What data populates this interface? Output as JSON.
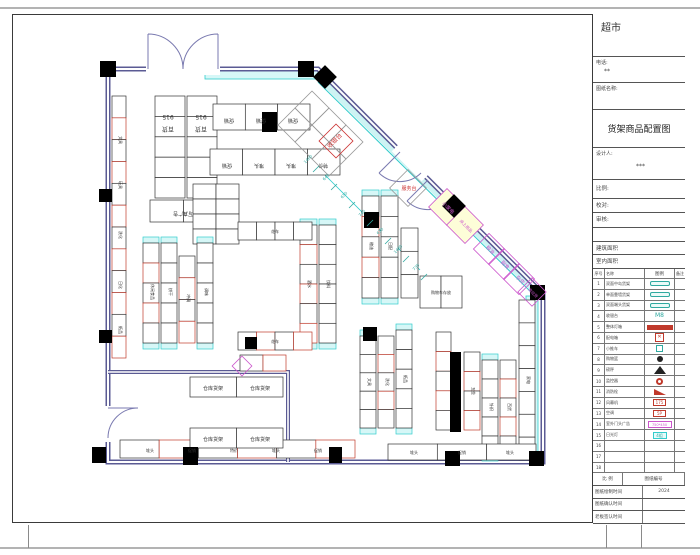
{
  "titleblock": {
    "store": "超市",
    "phone_label": "电话:",
    "phone": "**",
    "drawing_label": "图纸名称:",
    "title": "货架商品配置图",
    "designer_label": "设计人:",
    "designer": "***",
    "scale_label": "比例:",
    "check_label": "校对:",
    "audit_label": "审核:",
    "area1_label": "建筑面积",
    "area2_label": "室内面积",
    "legend_headers": [
      "序号",
      "名称",
      "图例",
      "备注"
    ],
    "legend_rows": [
      {
        "no": "1",
        "name": "双面中岛货架",
        "sym": "teal-pill",
        "symtext": "",
        "note": ""
      },
      {
        "no": "2",
        "name": "单面靠墙货架",
        "sym": "teal-pill",
        "symtext": "",
        "note": ""
      },
      {
        "no": "3",
        "name": "双面端头货架",
        "sym": "teal-pill",
        "symtext": "",
        "note": ""
      },
      {
        "no": "4",
        "name": "收银台",
        "sym": "teal-txt",
        "symtext": "M8",
        "note": ""
      },
      {
        "no": "5",
        "name": "整体灯箱",
        "sym": "red-bar",
        "symtext": "",
        "note": ""
      },
      {
        "no": "6",
        "name": "配电箱",
        "sym": "red-box",
        "symtext": "✕",
        "note": ""
      },
      {
        "no": "7",
        "name": "小推车",
        "sym": "teal-sm",
        "symtext": "",
        "note": ""
      },
      {
        "no": "8",
        "name": "购物篮",
        "sym": "black-dot",
        "symtext": "",
        "note": ""
      },
      {
        "no": "9",
        "name": "磅秤",
        "sym": "black-tri",
        "symtext": "",
        "note": ""
      },
      {
        "no": "10",
        "name": "监控器",
        "sym": "red-circle",
        "symtext": "",
        "note": ""
      },
      {
        "no": "11",
        "name": "消防栓",
        "sym": "red-flag",
        "symtext": "",
        "note": ""
      },
      {
        "no": "12",
        "name": "风幕机",
        "sym": "red-sm",
        "symtext": "175",
        "note": ""
      },
      {
        "no": "13",
        "name": "空调",
        "sym": "red-sm",
        "symtext": "5P",
        "note": ""
      },
      {
        "no": "14",
        "name": "室外门头广告",
        "sym": "magenta-box",
        "symtext": "750*450",
        "note": ""
      },
      {
        "no": "15",
        "name": "日光灯",
        "sym": "cyan-box",
        "symtext": "4组",
        "note": ""
      },
      {
        "no": "16",
        "name": "",
        "sym": "none",
        "symtext": "",
        "note": ""
      },
      {
        "no": "17",
        "name": "",
        "sym": "none",
        "symtext": "",
        "note": ""
      },
      {
        "no": "18",
        "name": "",
        "sym": "none",
        "symtext": "",
        "note": ""
      }
    ],
    "footer_headers": [
      "比 例",
      "图纸编号"
    ],
    "footer_rows": [
      {
        "label": "图纸绘制时间",
        "value": "2024"
      },
      {
        "label": "图纸确认时间",
        "value": ""
      },
      {
        "label": "老板签认时间",
        "value": ""
      }
    ]
  },
  "plan": {
    "labels": [
      {
        "t": "915",
        "x": 168,
        "y": 115,
        "r": 180,
        "s": 6
      },
      {
        "t": "百货",
        "x": 168,
        "y": 127,
        "r": 180,
        "s": 6
      },
      {
        "t": "915",
        "x": 201,
        "y": 115,
        "r": 180,
        "s": 6
      },
      {
        "t": "百货",
        "x": 201,
        "y": 127,
        "r": 180,
        "s": 6
      },
      {
        "t": "写真广告",
        "x": 183,
        "y": 212,
        "r": 180,
        "s": 5
      },
      {
        "t": "促销",
        "x": 229,
        "y": 119,
        "r": 180,
        "s": 5
      },
      {
        "t": "促销",
        "x": 261,
        "y": 119,
        "r": 180,
        "s": 5
      },
      {
        "t": "促销",
        "x": 293,
        "y": 119,
        "r": 180,
        "s": 5
      },
      {
        "t": "促销",
        "x": 227,
        "y": 164,
        "r": 180,
        "s": 5
      },
      {
        "t": "堆头",
        "x": 259,
        "y": 164,
        "r": 180,
        "s": 5
      },
      {
        "t": "堆头",
        "x": 291,
        "y": 164,
        "r": 180,
        "s": 5
      },
      {
        "t": "特价",
        "x": 323,
        "y": 164,
        "r": 180,
        "s": 5
      },
      {
        "t": "收银台",
        "x": 336,
        "y": 142,
        "r": -45,
        "c": "#cc3333",
        "s": 6
      },
      {
        "t": "服务台",
        "x": 409,
        "y": 190,
        "r": 0,
        "c": "#cc3333",
        "s": 5
      },
      {
        "t": "小家电",
        "x": 447,
        "y": 209,
        "r": 45,
        "c": "#cc55cc",
        "s": 5
      },
      {
        "t": "床上用品",
        "x": 465,
        "y": 227,
        "r": 45,
        "c": "#cc55cc",
        "s": 4
      },
      {
        "t": "粮油",
        "x": 489,
        "y": 251,
        "r": 45,
        "c": "#cc55cc",
        "s": 5
      },
      {
        "t": "副食",
        "x": 504,
        "y": 266,
        "r": 45,
        "c": "#cc55cc",
        "s": 5
      },
      {
        "t": "杂货",
        "x": 519,
        "y": 281,
        "r": 45,
        "c": "#cc55cc",
        "s": 5
      },
      {
        "t": "南北货",
        "x": 532,
        "y": 294,
        "r": 45,
        "c": "#cc55cc",
        "s": 4
      },
      {
        "t": "文具",
        "x": 119,
        "y": 140,
        "r": 90,
        "s": 4
      },
      {
        "t": "玩具",
        "x": 119,
        "y": 185,
        "r": 90,
        "s": 4
      },
      {
        "t": "洗化",
        "x": 119,
        "y": 235,
        "r": 90,
        "s": 4
      },
      {
        "t": "日化",
        "x": 119,
        "y": 285,
        "r": 90,
        "s": 4
      },
      {
        "t": "纸品",
        "x": 119,
        "y": 330,
        "r": 90,
        "s": 4
      },
      {
        "t": "休闲食品",
        "x": 151,
        "y": 292,
        "r": 90,
        "s": 4
      },
      {
        "t": "饼干",
        "x": 169,
        "y": 292,
        "r": 90,
        "s": 4
      },
      {
        "t": "冲调",
        "x": 187,
        "y": 298,
        "r": 90,
        "s": 4
      },
      {
        "t": "调味",
        "x": 205,
        "y": 292,
        "r": 90,
        "s": 4
      },
      {
        "t": "酒水",
        "x": 308,
        "y": 284,
        "r": 90,
        "s": 4
      },
      {
        "t": "饮料",
        "x": 327,
        "y": 284,
        "r": 90,
        "s": 4
      },
      {
        "t": "粮油",
        "x": 370,
        "y": 246,
        "r": 90,
        "s": 4
      },
      {
        "t": "日配",
        "x": 389,
        "y": 246,
        "r": 90,
        "s": 4
      },
      {
        "t": "文具",
        "x": 368,
        "y": 382,
        "r": 90,
        "s": 4
      },
      {
        "t": "洗化",
        "x": 386,
        "y": 382,
        "r": 90,
        "s": 4
      },
      {
        "t": "纸品",
        "x": 404,
        "y": 379,
        "r": 90,
        "s": 4
      },
      {
        "t": "五金",
        "x": 472,
        "y": 391,
        "r": 90,
        "s": 4
      },
      {
        "t": "针织",
        "x": 490,
        "y": 407,
        "r": 90,
        "s": 4
      },
      {
        "t": "百货",
        "x": 508,
        "y": 407,
        "r": 90,
        "s": 4
      },
      {
        "t": "家电",
        "x": 527,
        "y": 380,
        "r": 90,
        "s": 4
      },
      {
        "t": "仓库货架",
        "x": 213,
        "y": 390,
        "r": 0,
        "s": 5
      },
      {
        "t": "仓库货架",
        "x": 260,
        "y": 390,
        "r": 0,
        "s": 5
      },
      {
        "t": "仓库货架",
        "x": 213,
        "y": 441,
        "r": 0,
        "s": 5
      },
      {
        "t": "仓库货架",
        "x": 260,
        "y": 441,
        "r": 0,
        "s": 5
      },
      {
        "t": "堆头",
        "x": 150,
        "y": 452,
        "r": 0,
        "s": 4
      },
      {
        "t": "促销",
        "x": 192,
        "y": 452,
        "r": 0,
        "s": 4
      },
      {
        "t": "特价",
        "x": 234,
        "y": 452,
        "r": 0,
        "s": 4
      },
      {
        "t": "堆头",
        "x": 276,
        "y": 452,
        "r": 0,
        "s": 4
      },
      {
        "t": "促销",
        "x": 318,
        "y": 452,
        "r": 0,
        "s": 4
      },
      {
        "t": "堆头",
        "x": 414,
        "y": 454,
        "r": 0,
        "s": 4
      },
      {
        "t": "促销",
        "x": 462,
        "y": 454,
        "r": 0,
        "s": 4
      },
      {
        "t": "堆头",
        "x": 510,
        "y": 454,
        "r": 0,
        "s": 4
      },
      {
        "t": "购物车存放",
        "x": 441,
        "y": 294,
        "r": 0,
        "s": 4
      },
      {
        "t": "花车",
        "x": 275,
        "y": 233,
        "r": 0,
        "s": 4
      },
      {
        "t": "花车",
        "x": 275,
        "y": 343,
        "r": 0,
        "s": 4
      }
    ],
    "dims": [
      {
        "t": "1460",
        "x": 309,
        "y": 160
      },
      {
        "t": "640",
        "x": 327,
        "y": 178
      },
      {
        "t": "650",
        "x": 345,
        "y": 196
      },
      {
        "t": "740",
        "x": 363,
        "y": 214
      },
      {
        "t": "650",
        "x": 381,
        "y": 232
      },
      {
        "t": "1480",
        "x": 399,
        "y": 250
      },
      {
        "t": "730",
        "x": 417,
        "y": 268
      }
    ],
    "shelf_groups": [
      {
        "x": 155,
        "y": 96,
        "w": 30,
        "h": 102,
        "cols": 1,
        "rows": 5
      },
      {
        "x": 187,
        "y": 96,
        "w": 30,
        "h": 102,
        "cols": 1,
        "rows": 5
      },
      {
        "x": 150,
        "y": 200,
        "w": 67,
        "h": 22,
        "cols": 2,
        "rows": 1
      },
      {
        "x": 213,
        "y": 104,
        "w": 97,
        "h": 26,
        "cols": 3,
        "rows": 1
      },
      {
        "x": 210,
        "y": 149,
        "w": 130,
        "h": 26,
        "cols": 4,
        "rows": 1
      },
      {
        "x": 193,
        "y": 184,
        "w": 46,
        "h": 60,
        "cols": 2,
        "rows": 4
      },
      {
        "x": 300,
        "y": 225,
        "w": 17,
        "h": 118,
        "cols": 1,
        "rows": 6,
        "cap": "v",
        "mix": true
      },
      {
        "x": 319,
        "y": 225,
        "w": 17,
        "h": 118,
        "cols": 1,
        "rows": 6,
        "cap": "v"
      },
      {
        "x": 143,
        "y": 243,
        "w": 16,
        "h": 100,
        "cols": 1,
        "rows": 5,
        "cap": "v",
        "mix": true
      },
      {
        "x": 161,
        "y": 243,
        "w": 16,
        "h": 100,
        "cols": 1,
        "rows": 5,
        "cap": "v"
      },
      {
        "x": 179,
        "y": 256,
        "w": 16,
        "h": 87,
        "cols": 1,
        "rows": 4,
        "mix": true
      },
      {
        "x": 197,
        "y": 243,
        "w": 16,
        "h": 100,
        "cols": 1,
        "rows": 5,
        "cap": "v"
      },
      {
        "x": 362,
        "y": 196,
        "w": 17,
        "h": 102,
        "cols": 1,
        "rows": 5,
        "cap": "v",
        "mix": true
      },
      {
        "x": 381,
        "y": 196,
        "w": 17,
        "h": 102,
        "cols": 1,
        "rows": 5,
        "cap": "v"
      },
      {
        "x": 401,
        "y": 228,
        "w": 17,
        "h": 70,
        "cols": 1,
        "rows": 3
      },
      {
        "x": 360,
        "y": 336,
        "w": 16,
        "h": 92,
        "cols": 1,
        "rows": 5,
        "cap": "v"
      },
      {
        "x": 378,
        "y": 336,
        "w": 16,
        "h": 92,
        "cols": 1,
        "rows": 5,
        "mix": true
      },
      {
        "x": 396,
        "y": 330,
        "w": 16,
        "h": 98,
        "cols": 1,
        "rows": 5,
        "cap": "v"
      },
      {
        "x": 436,
        "y": 332,
        "w": 15,
        "h": 98,
        "cols": 1,
        "rows": 5,
        "mix": true
      },
      {
        "x": 464,
        "y": 352,
        "w": 16,
        "h": 78,
        "cols": 1,
        "rows": 4,
        "mix": true
      },
      {
        "x": 482,
        "y": 360,
        "w": 16,
        "h": 95,
        "cols": 1,
        "rows": 5,
        "cap": "v"
      },
      {
        "x": 500,
        "y": 360,
        "w": 16,
        "h": 95,
        "cols": 1,
        "rows": 5,
        "mix": true
      },
      {
        "x": 519,
        "y": 300,
        "w": 16,
        "h": 160,
        "cols": 1,
        "rows": 7
      },
      {
        "x": 112,
        "y": 96,
        "w": 14,
        "h": 262,
        "cols": 1,
        "rows": 12,
        "mix": true
      },
      {
        "x": 120,
        "y": 440,
        "w": 235,
        "h": 18,
        "cols": 6,
        "rows": 1,
        "mix": true
      },
      {
        "x": 388,
        "y": 444,
        "w": 148,
        "h": 16,
        "cols": 3,
        "rows": 1
      },
      {
        "x": 238,
        "y": 222,
        "w": 74,
        "h": 18,
        "cols": 4,
        "rows": 1
      },
      {
        "x": 238,
        "y": 332,
        "w": 74,
        "h": 18,
        "cols": 4,
        "rows": 1,
        "mix": true
      },
      {
        "x": 420,
        "y": 276,
        "w": 42,
        "h": 32,
        "cols": 2,
        "rows": 1
      },
      {
        "x": 190,
        "y": 377,
        "w": 93,
        "h": 20,
        "cols": 2,
        "rows": 1
      },
      {
        "x": 190,
        "y": 428,
        "w": 93,
        "h": 20,
        "cols": 2,
        "rows": 1
      },
      {
        "x": 240,
        "y": 355,
        "w": 46,
        "h": 16,
        "cols": 2,
        "rows": 1,
        "mix": true
      }
    ],
    "columns": [
      {
        "x": 100,
        "y": 61,
        "w": 16,
        "h": 16
      },
      {
        "x": 298,
        "y": 61,
        "w": 16,
        "h": 16
      },
      {
        "x": 99,
        "y": 189,
        "w": 13,
        "h": 13
      },
      {
        "x": 99,
        "y": 330,
        "w": 13,
        "h": 13
      },
      {
        "x": 92,
        "y": 447,
        "w": 14,
        "h": 16
      },
      {
        "x": 183,
        "y": 447,
        "w": 15,
        "h": 18
      },
      {
        "x": 445,
        "y": 451,
        "w": 15,
        "h": 15
      },
      {
        "x": 529,
        "y": 451,
        "w": 15,
        "h": 15
      },
      {
        "x": 530,
        "y": 285,
        "w": 15,
        "h": 15
      },
      {
        "x": 262,
        "y": 112,
        "w": 15,
        "h": 20
      },
      {
        "x": 364,
        "y": 212,
        "w": 15,
        "h": 16
      },
      {
        "x": 363,
        "y": 327,
        "w": 14,
        "h": 14
      },
      {
        "x": 450,
        "y": 352,
        "w": 11,
        "h": 80
      },
      {
        "x": 329,
        "y": 447,
        "w": 13,
        "h": 16
      },
      {
        "x": 245,
        "y": 337,
        "w": 12,
        "h": 12
      }
    ],
    "diamonds": [
      {
        "cx": 312,
        "cy": 108,
        "s": 24,
        "st": "#999"
      },
      {
        "cx": 329,
        "cy": 125,
        "s": 24,
        "st": "#999"
      },
      {
        "cx": 346,
        "cy": 142,
        "s": 24,
        "st": "#999"
      },
      {
        "cx": 295,
        "cy": 125,
        "s": 24,
        "st": "#999"
      },
      {
        "cx": 312,
        "cy": 142,
        "s": 24,
        "st": "#999"
      },
      {
        "cx": 329,
        "cy": 159,
        "s": 24,
        "st": "#999"
      },
      {
        "cx": 336,
        "cy": 141,
        "s": 24,
        "st": "#cc3333"
      },
      {
        "cx": 408,
        "cy": 188,
        "s": 26,
        "st": "#999"
      },
      {
        "cx": 447,
        "cy": 207,
        "s": 26,
        "st": "#cc55cc",
        "f": "#fdfdd8"
      },
      {
        "cx": 465,
        "cy": 225,
        "s": 26,
        "st": "#cc55cc",
        "f": "#fdfdd8"
      },
      {
        "cx": 489,
        "cy": 249,
        "s": 22,
        "st": "#cc55cc"
      },
      {
        "cx": 504,
        "cy": 264,
        "s": 22,
        "st": "#cc55cc"
      },
      {
        "cx": 519,
        "cy": 279,
        "s": 22,
        "st": "#cc55cc"
      },
      {
        "cx": 532,
        "cy": 292,
        "s": 20,
        "st": "#cc55cc"
      },
      {
        "cx": 325,
        "cy": 77,
        "s": 16,
        "st": "#000",
        "f": "#000"
      },
      {
        "cx": 454,
        "cy": 206,
        "s": 16,
        "st": "#000",
        "f": "#000"
      },
      {
        "cx": 242,
        "cy": 366,
        "s": 14,
        "st": "#cc55cc"
      }
    ]
  }
}
